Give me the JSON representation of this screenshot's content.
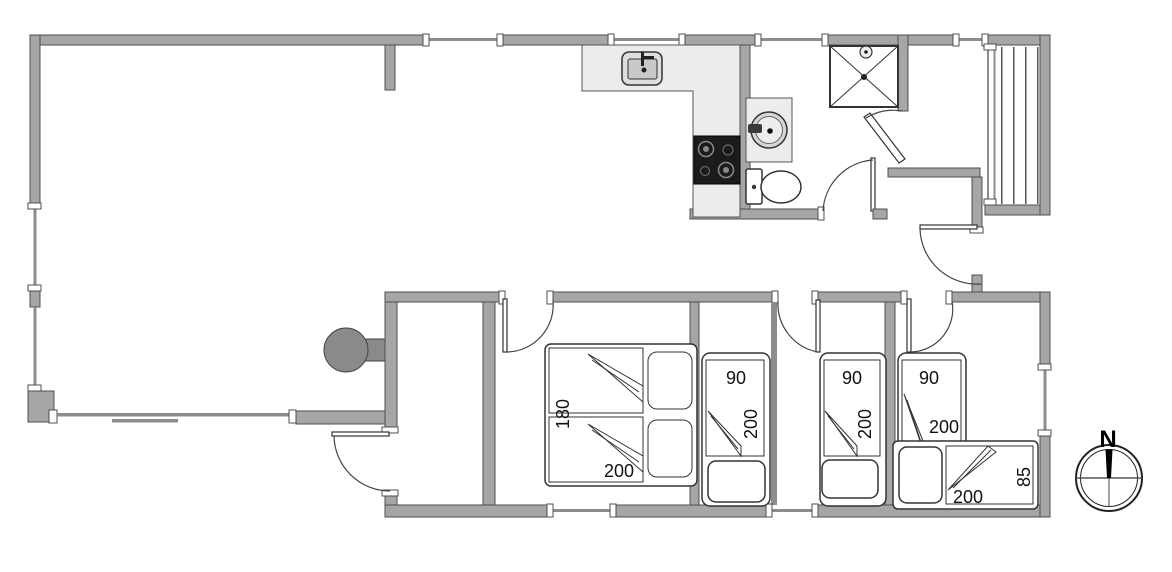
{
  "plan": {
    "colors": {
      "wall": "#a6a6a6",
      "wall_outline": "#4f4f4f",
      "counter": "#ececec",
      "fixture_outline": "#333333",
      "stove_top": "#1b1b1b",
      "wood_stove": "#8a8a8a",
      "deck_plank": "#555555",
      "label_text": "#111111",
      "floor": "#ffffff"
    },
    "beds": [
      {
        "name": "double-bed",
        "width_label": "180",
        "length_label": "200"
      },
      {
        "name": "single-bed-1",
        "width_label": "90",
        "length_label": "200"
      },
      {
        "name": "single-bed-2",
        "width_label": "90",
        "length_label": "200"
      },
      {
        "name": "corner-bed-vertical",
        "width_label": "90",
        "length_label": "200"
      },
      {
        "name": "corner-bed-horizontal",
        "width_label": "85",
        "length_label": "200"
      }
    ],
    "compass": {
      "north_label": "N"
    }
  }
}
